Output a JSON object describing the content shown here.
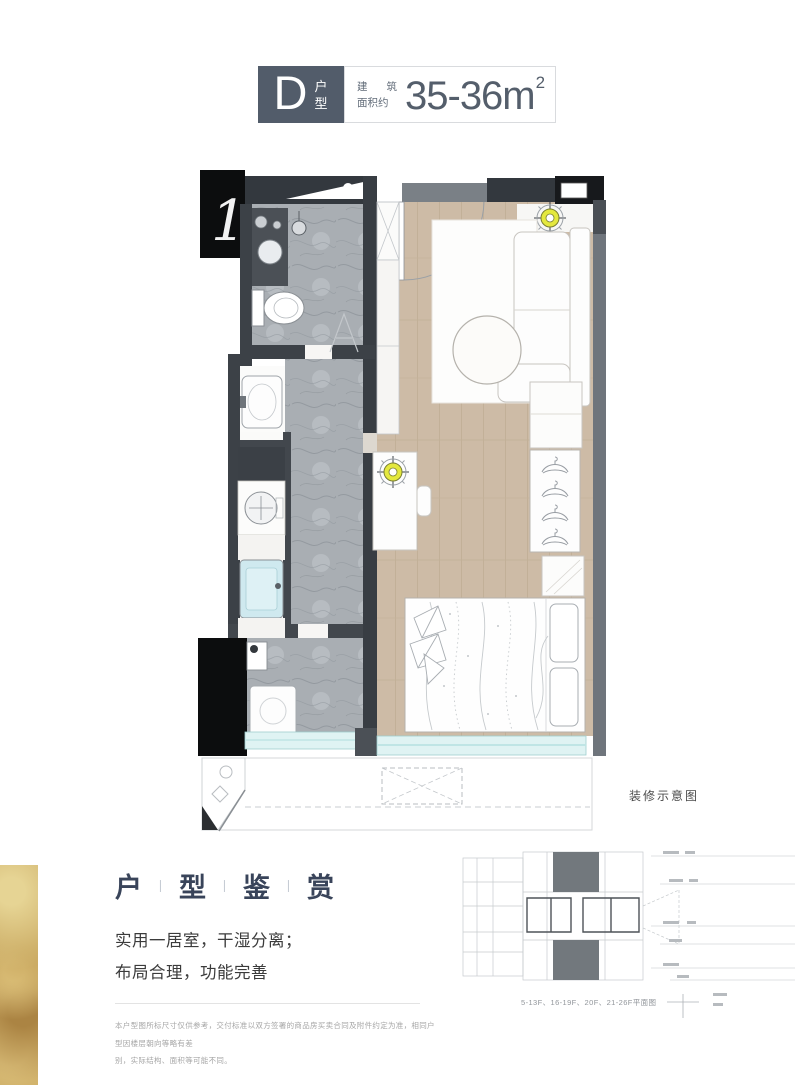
{
  "header": {
    "unit_letter": "D",
    "unit_word_top": "户",
    "unit_word_bottom": "型",
    "area_label_top": [
      "建",
      "筑"
    ],
    "area_label_bottom": "面积约",
    "area_value": "35-36m",
    "area_sup": "2",
    "badge_color": "#525c6a"
  },
  "floorplan": {
    "shaft_label": "1",
    "note": "装修示意图",
    "colors": {
      "wall_dark": "#33383e",
      "wall_mid": "#6f757c",
      "wood": "#cdbba6",
      "marble": "#a9aeb3",
      "window": "#dff3f3",
      "downlight_accent": "#e4e83e"
    }
  },
  "appreciation": {
    "title": [
      "户",
      "型",
      "鉴",
      "赏"
    ],
    "separator": "丨",
    "line1": "实用一居室，干湿分离；",
    "line2": "布局合理，功能完善",
    "disclaimer_line1": "本户型图所标尺寸仅供参考，交付标准以双方签署的商品房买卖合同及附件约定为准，相同户型因楼层朝向等略有差",
    "disclaimer_line2": "别，实际结构、面积等可能不同。"
  },
  "keyplan": {
    "caption": "5-13F、16-19F、20F、21-26F平面图"
  }
}
